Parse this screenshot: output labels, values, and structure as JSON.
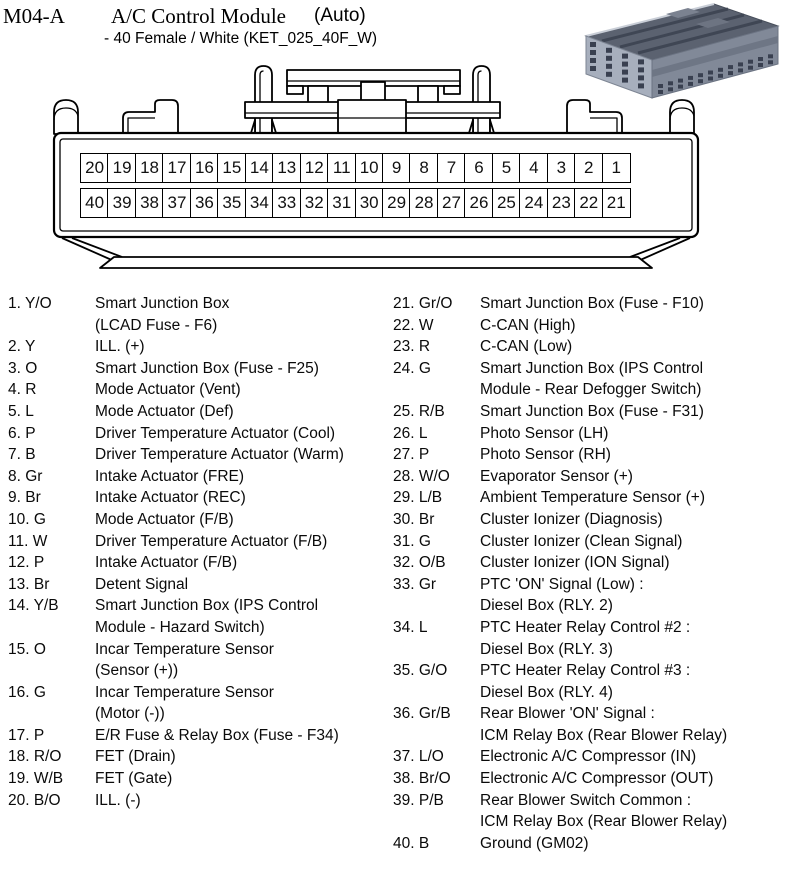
{
  "header": {
    "connector_id": "M04-A",
    "title": "A/C Control Module",
    "variant": "(Auto)",
    "subtitle": "- 40 Female / White (KET_025_40F_W)"
  },
  "connector": {
    "top_row_pins": [
      20,
      19,
      18,
      17,
      16,
      15,
      14,
      13,
      12,
      11,
      10,
      9,
      8,
      7,
      6,
      5,
      4,
      3,
      2,
      1
    ],
    "bottom_row_pins": [
      40,
      39,
      38,
      37,
      36,
      35,
      34,
      33,
      32,
      31,
      30,
      29,
      28,
      27,
      26,
      25,
      24,
      23,
      22,
      21
    ]
  },
  "photo": {
    "icon": "connector-3d-photo",
    "body_color": "#a7afbd",
    "top_color": "#5b6270",
    "side_color": "#818998",
    "hole_color": "#394050"
  },
  "pins_left": [
    {
      "n": 1,
      "w": "Y/O",
      "d": [
        "Smart Junction Box",
        "(LCAD Fuse - F6)"
      ]
    },
    {
      "n": 2,
      "w": "Y",
      "d": [
        "ILL. (+)"
      ]
    },
    {
      "n": 3,
      "w": "O",
      "d": [
        "Smart Junction Box (Fuse - F25)"
      ]
    },
    {
      "n": 4,
      "w": "R",
      "d": [
        "Mode Actuator (Vent)"
      ]
    },
    {
      "n": 5,
      "w": "L",
      "d": [
        "Mode Actuator (Def)"
      ]
    },
    {
      "n": 6,
      "w": "P",
      "d": [
        "Driver Temperature Actuator (Cool)"
      ]
    },
    {
      "n": 7,
      "w": "B",
      "d": [
        "Driver Temperature Actuator (Warm)"
      ]
    },
    {
      "n": 8,
      "w": "Gr",
      "d": [
        "Intake Actuator (FRE)"
      ]
    },
    {
      "n": 9,
      "w": "Br",
      "d": [
        "Intake Actuator (REC)"
      ]
    },
    {
      "n": 10,
      "w": "G",
      "d": [
        "Mode Actuator (F/B)"
      ]
    },
    {
      "n": 11,
      "w": "W",
      "d": [
        "Driver Temperature Actuator (F/B)"
      ]
    },
    {
      "n": 12,
      "w": "P",
      "d": [
        "Intake Actuator (F/B)"
      ]
    },
    {
      "n": 13,
      "w": "Br",
      "d": [
        "Detent Signal"
      ]
    },
    {
      "n": 14,
      "w": "Y/B",
      "d": [
        "Smart Junction Box (IPS Control",
        "Module - Hazard Switch)"
      ]
    },
    {
      "n": 15,
      "w": "O",
      "d": [
        "Incar Temperature Sensor",
        "(Sensor (+))"
      ]
    },
    {
      "n": 16,
      "w": "G",
      "d": [
        "Incar Temperature Sensor",
        "(Motor (-))"
      ]
    },
    {
      "n": 17,
      "w": "P",
      "d": [
        "E/R Fuse & Relay Box (Fuse - F34)"
      ]
    },
    {
      "n": 18,
      "w": "R/O",
      "d": [
        "FET (Drain)"
      ]
    },
    {
      "n": 19,
      "w": "W/B",
      "d": [
        "FET (Gate)"
      ]
    },
    {
      "n": 20,
      "w": "B/O",
      "d": [
        "ILL. (-)"
      ]
    }
  ],
  "pins_right": [
    {
      "n": 21,
      "w": "Gr/O",
      "d": [
        "Smart Junction Box (Fuse - F10)"
      ]
    },
    {
      "n": 22,
      "w": "W",
      "d": [
        "C-CAN (High)"
      ]
    },
    {
      "n": 23,
      "w": "R",
      "d": [
        "C-CAN (Low)"
      ]
    },
    {
      "n": 24,
      "w": "G",
      "d": [
        "Smart Junction Box (IPS Control",
        "Module - Rear Defogger Switch)"
      ]
    },
    {
      "n": 25,
      "w": "R/B",
      "d": [
        "Smart Junction Box (Fuse - F31)"
      ]
    },
    {
      "n": 26,
      "w": "L",
      "d": [
        "Photo Sensor (LH)"
      ]
    },
    {
      "n": 27,
      "w": "P",
      "d": [
        "Photo Sensor (RH)"
      ]
    },
    {
      "n": 28,
      "w": "W/O",
      "d": [
        "Evaporator Sensor (+)"
      ]
    },
    {
      "n": 29,
      "w": "L/B",
      "d": [
        "Ambient Temperature Sensor (+)"
      ]
    },
    {
      "n": 30,
      "w": "Br",
      "d": [
        "Cluster Ionizer (Diagnosis)"
      ]
    },
    {
      "n": 31,
      "w": "G",
      "d": [
        "Cluster Ionizer (Clean Signal)"
      ]
    },
    {
      "n": 32,
      "w": "O/B",
      "d": [
        "Cluster Ionizer (ION Signal)"
      ]
    },
    {
      "n": 33,
      "w": "Gr",
      "d": [
        "PTC 'ON' Signal (Low) :",
        "Diesel Box (RLY. 2)"
      ]
    },
    {
      "n": 34,
      "w": "L",
      "d": [
        "PTC Heater Relay Control #2 :",
        "Diesel Box (RLY. 3)"
      ]
    },
    {
      "n": 35,
      "w": "G/O",
      "d": [
        "PTC Heater Relay Control #3 :",
        "Diesel Box (RLY. 4)"
      ]
    },
    {
      "n": 36,
      "w": "Gr/B",
      "d": [
        "Rear Blower 'ON' Signal :",
        "ICM Relay Box (Rear Blower Relay)"
      ]
    },
    {
      "n": 37,
      "w": "L/O",
      "d": [
        "Electronic A/C Compressor (IN)"
      ]
    },
    {
      "n": 38,
      "w": "Br/O",
      "d": [
        "Electronic A/C Compressor (OUT)"
      ]
    },
    {
      "n": 39,
      "w": "P/B",
      "d": [
        "Rear Blower Switch Common :",
        "ICM Relay Box (Rear Blower Relay)"
      ]
    },
    {
      "n": 40,
      "w": "B",
      "d": [
        "Ground (GM02)"
      ]
    }
  ]
}
